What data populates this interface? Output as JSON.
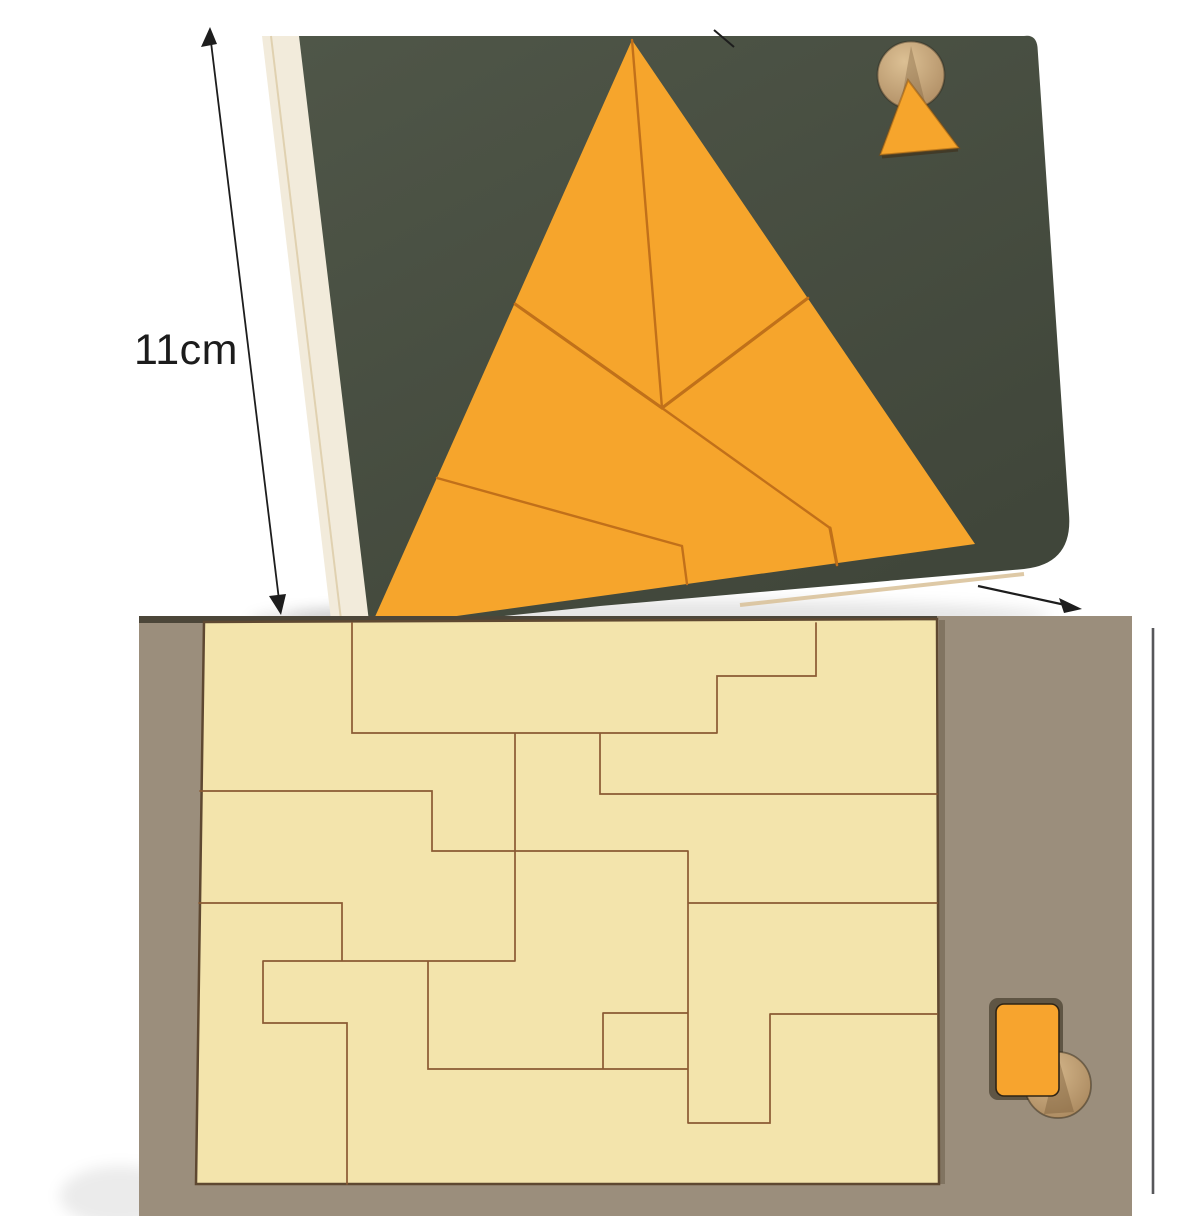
{
  "photo": {
    "kind": "product-photo-collage",
    "sections": 2
  },
  "dimension_label": {
    "text": "11cm"
  },
  "top_photo": {
    "board": "triangle-puzzle-board",
    "board_color": "#4a5143",
    "piece_color": "#f6a52c",
    "seam_color": "#c1701a",
    "edge_color": "#f2ebdb",
    "corner_hole": "round-hole",
    "corner_hole_wood_color": "#c9a87d",
    "corner_piece": "small-triangle-piece"
  },
  "bottom_photo": {
    "board": "rectangle-puzzle-tray",
    "board_color": "#9b8e7c",
    "field_color": "#f3e4ac",
    "seam_color": "#8a5a33",
    "side_piece": "orange-rectangle-piece",
    "side_piece_color": "#f7a42e",
    "side_hole": "round-hole",
    "hole_wood_color": "#c9a87d"
  }
}
